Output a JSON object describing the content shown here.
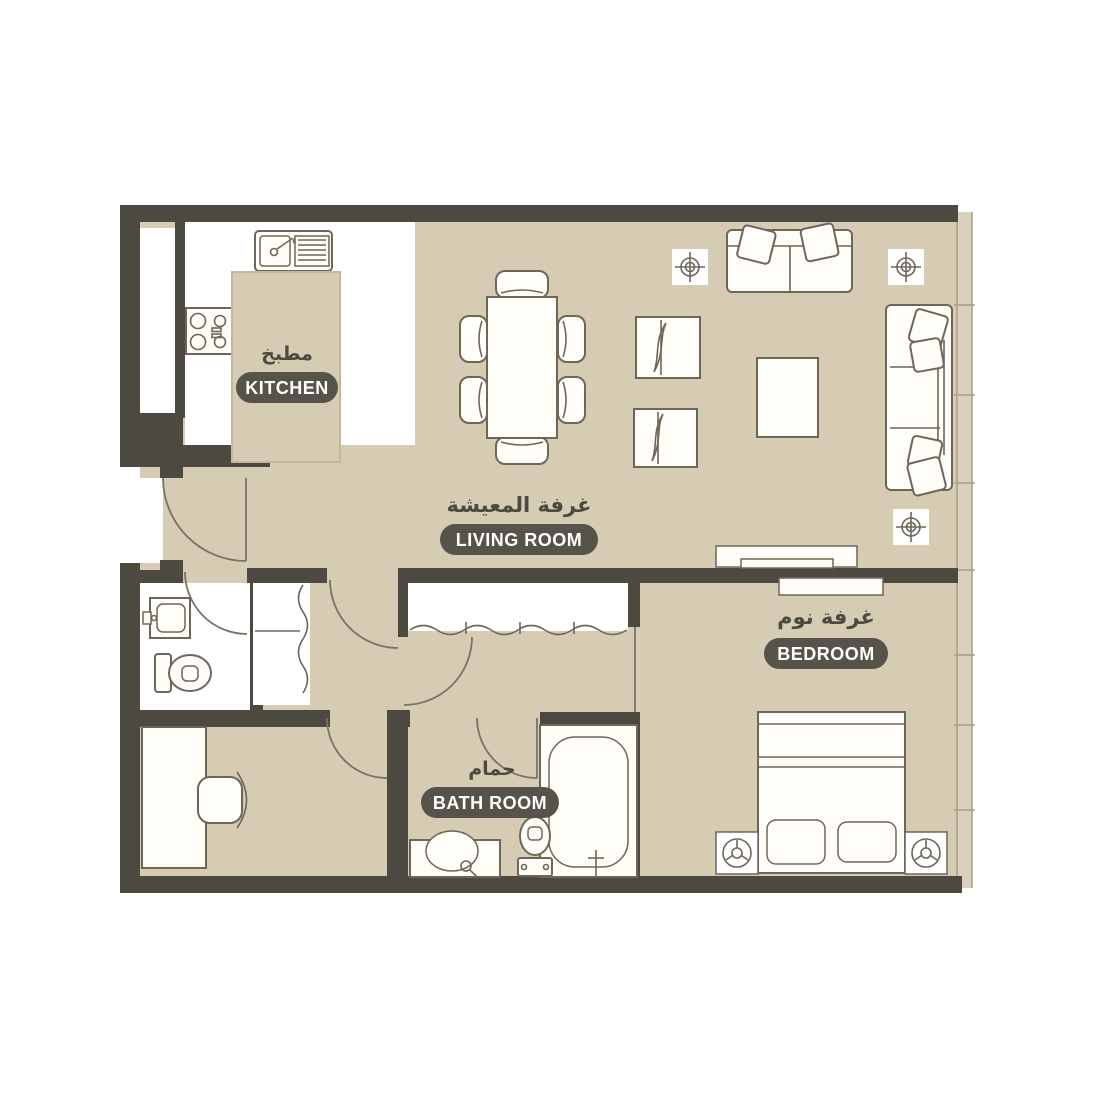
{
  "colors": {
    "background": "#ffffff",
    "floor": "#d5ccb3",
    "wall": "#4c4a40",
    "label_pill": "#55534a",
    "label_pill_text": "#ffffff",
    "arabic_text": "#4c4a40",
    "window_strip": "#d9d1bb",
    "furniture_stroke": "#6e6659",
    "kitchen_floor": "#ffffff"
  },
  "rooms": {
    "kitchen": {
      "label_en": "KITCHEN",
      "label_ar": "مطبخ"
    },
    "living_room": {
      "label_en": "LIVING ROOM",
      "label_ar": "غرفة المعيشة"
    },
    "bedroom": {
      "label_en": "BEDROOM",
      "label_ar": "غرفة نوم"
    },
    "bathroom": {
      "label_en": "BATH ROOM",
      "label_ar": "حمام"
    }
  }
}
